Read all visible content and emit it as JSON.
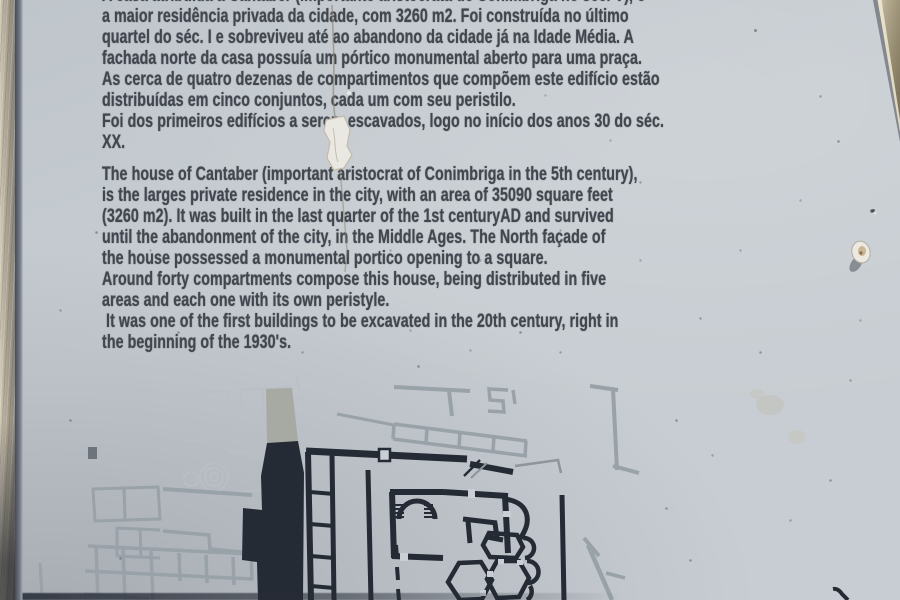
{
  "sign": {
    "portuguese_text": {
      "lines": [
        "A casa atribuída a Cantaber (importante aristocrata de Conimbriga no séc. V), é",
        "a maior residência privada da cidade, com 3260 m2. Foi construída no último",
        "quartel do séc. I e sobreviveu até ao abandono da cidade já na Idade Média. A",
        "fachada norte da casa possuía um pórtico monumental aberto para uma praça.",
        "As cerca de quatro dezenas de compartimentos que compõem este edifício estão",
        "distribuídas em cinco conjuntos, cada um com seu peristilo.",
        "Foi dos primeiros edifícios a serem escavados, logo no início dos anos 30 do séc.",
        "XX."
      ]
    },
    "english_text": {
      "lines": [
        "The house of Cantaber (important aristocrat of Conimbriga in the 5th century),",
        "is the larges private residence in the city, with an area of 35090 square feet",
        "(3260 m2). It was built in the last quarter of the 1st centuryAD and survived",
        "until the abandonment of the city, in the Middle Ages. The North façade of",
        "the house possessed a monumental portico opening to a square.",
        "Around forty compartments compose this house, being distributed in five",
        "areas and each one with its own peristyle.",
        " It was one of the first buildings to be excavated in the 20th century, right in",
        "the beginning of the 1930's."
      ]
    }
  },
  "colors": {
    "plaque_background": "#c7cdd2",
    "ink": "#42474f",
    "plan_black": "#252b34",
    "plan_gray": "#99a1a9",
    "plan_faint": "#b9bfc5",
    "frame_tan": "#a69d8b"
  }
}
